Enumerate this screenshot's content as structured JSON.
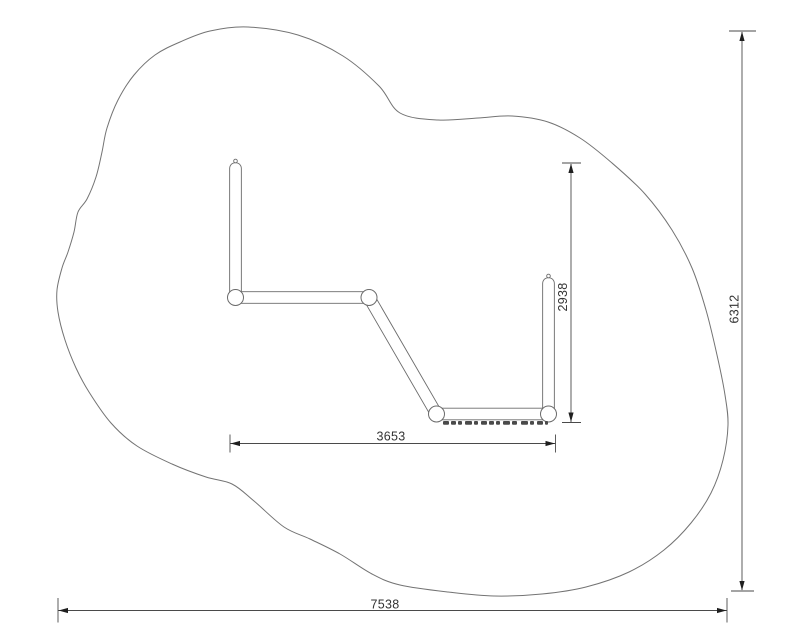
{
  "drawing": {
    "background": "#ffffff",
    "colors": {
      "zone_outline": "#737373",
      "equipment_line": "#6b6b6b",
      "dimension_line": "#4a4a4a",
      "arrow": "#1f1f1f",
      "text": "#333333",
      "tread": "#4a4a4a"
    },
    "dimensions": {
      "overall_width": "7538",
      "overall_height": "6312",
      "equipment_width": "3653",
      "equipment_height": "2938"
    }
  }
}
